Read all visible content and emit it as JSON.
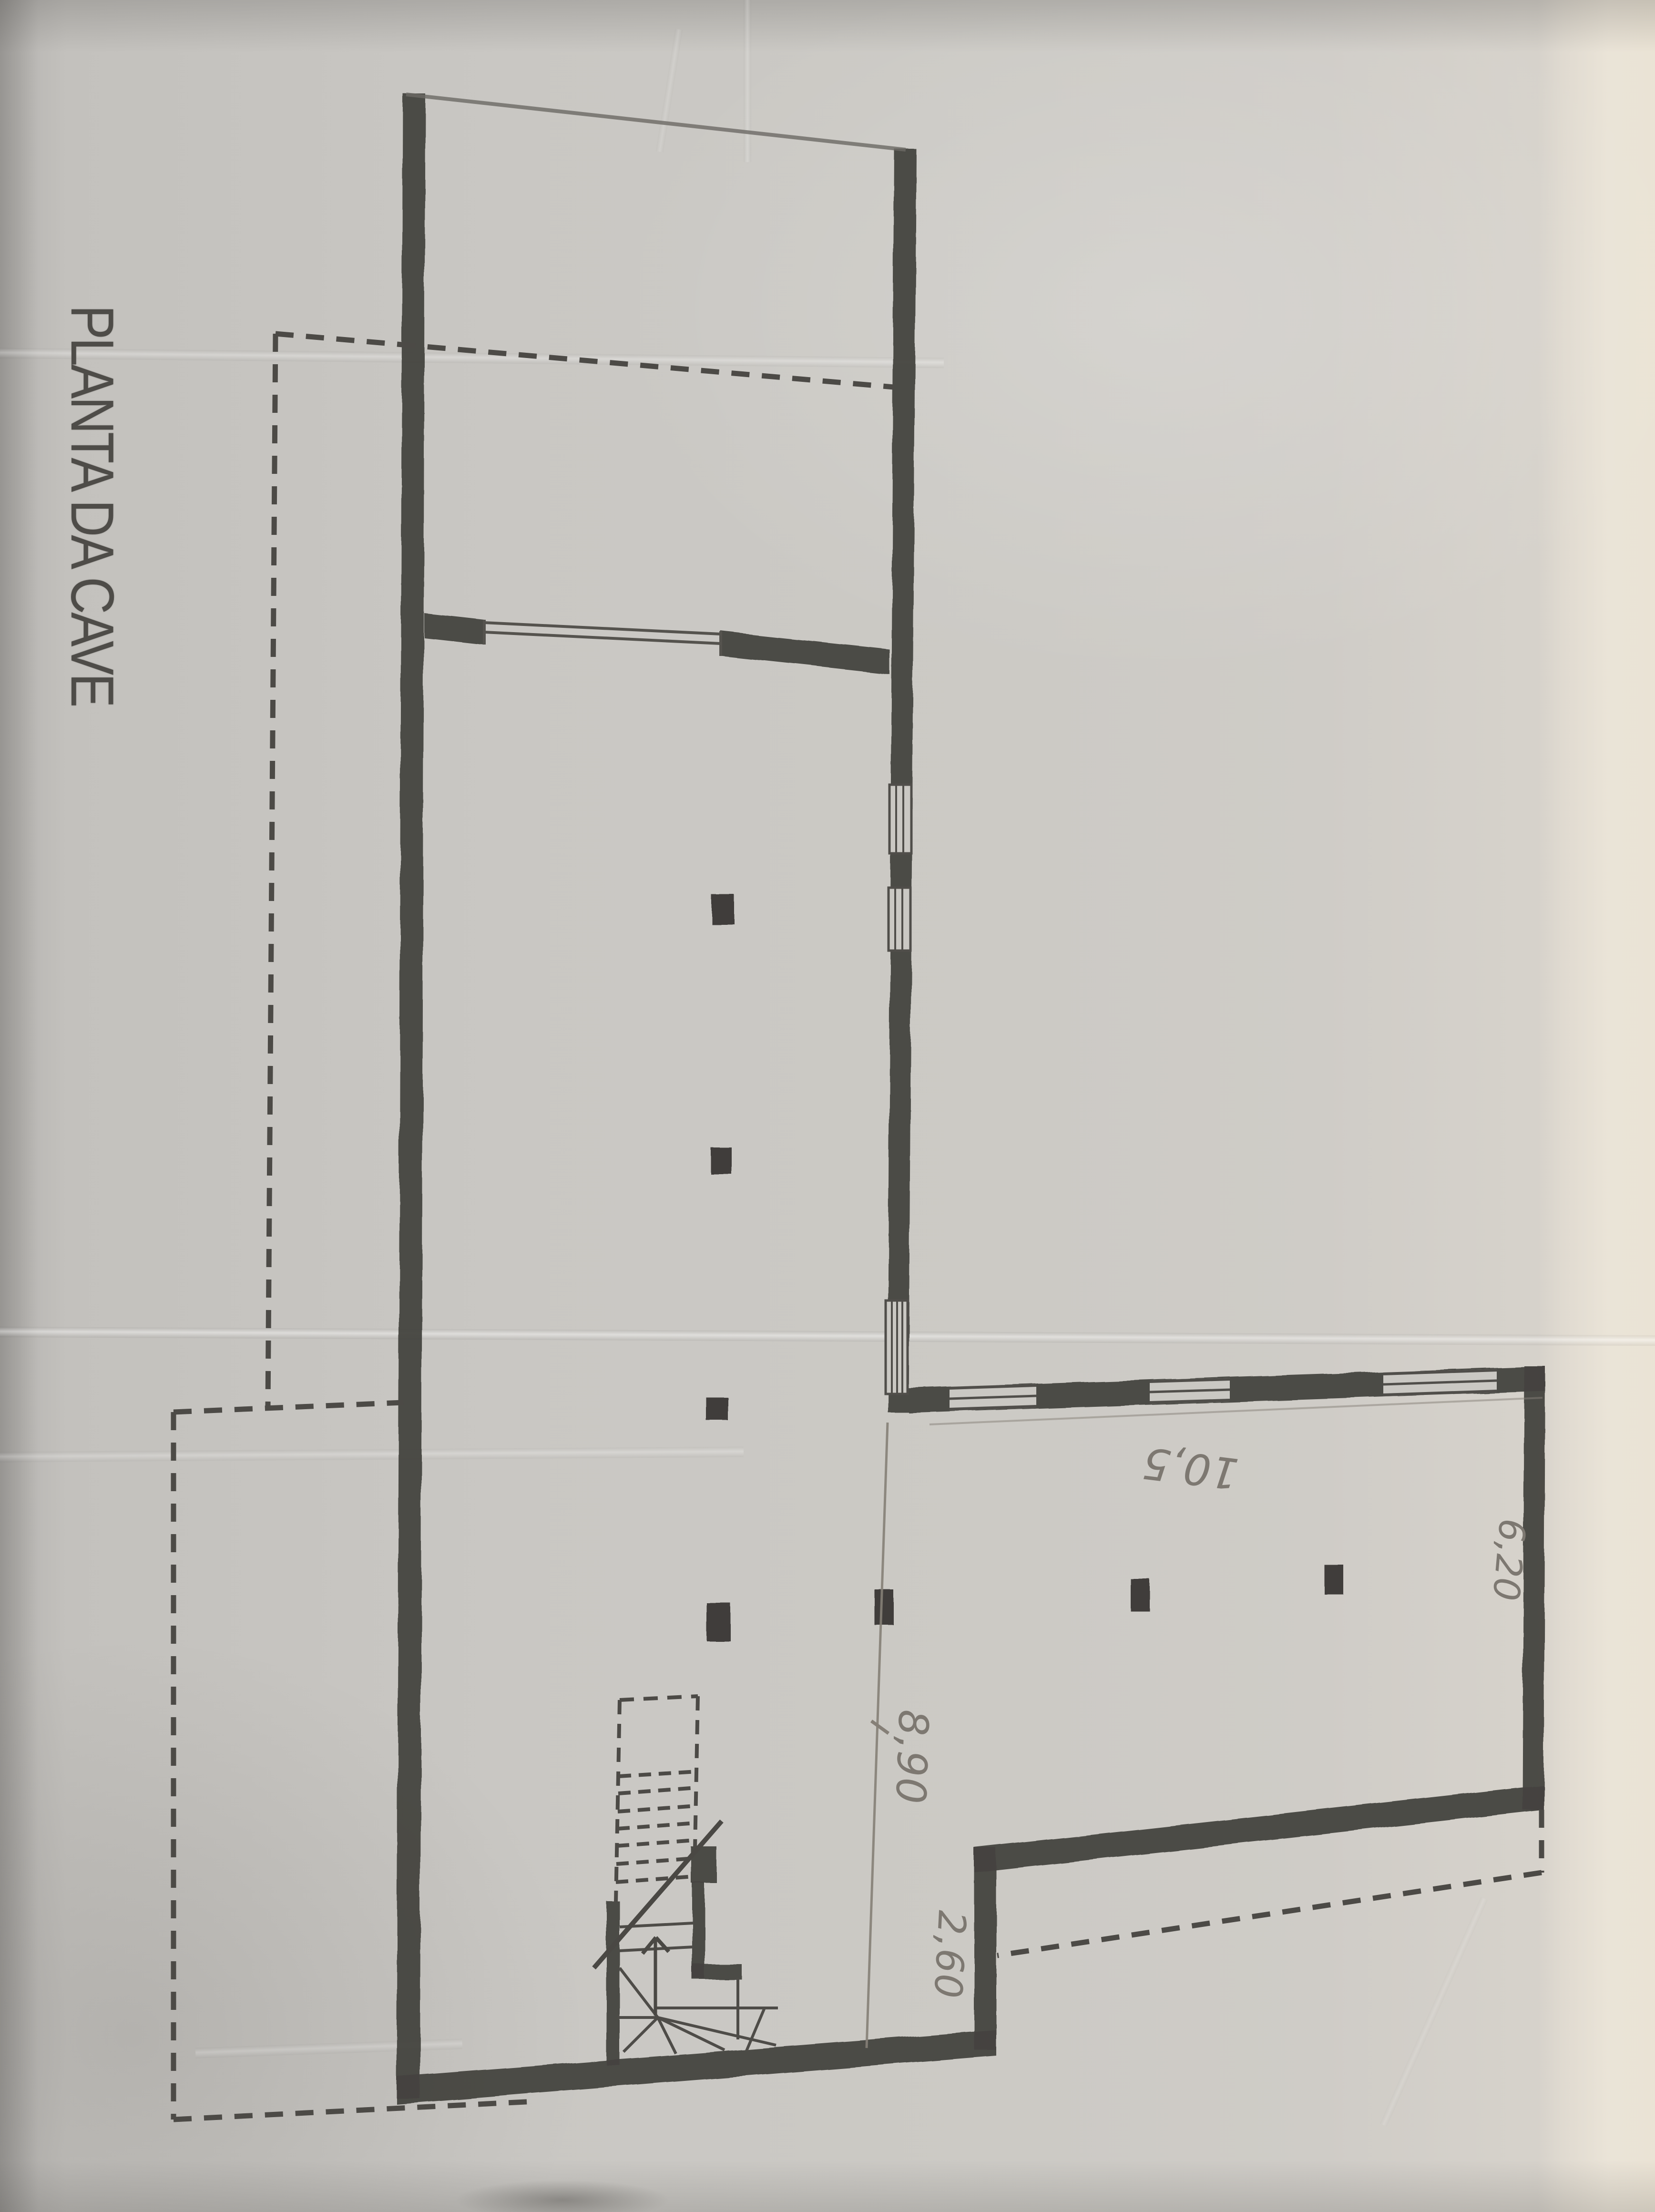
{
  "document": {
    "title": "PLANTA DA CAVE"
  },
  "dimensions": {
    "room_depth": "8,90",
    "step_offset": "2,60",
    "hall_width": "10,5",
    "right_side": "6,20"
  },
  "colors": {
    "paper": "#cac8c3",
    "wall_ink": "#454340",
    "pencil": "#7d7871",
    "bright_strip": "#f0e8dc"
  }
}
